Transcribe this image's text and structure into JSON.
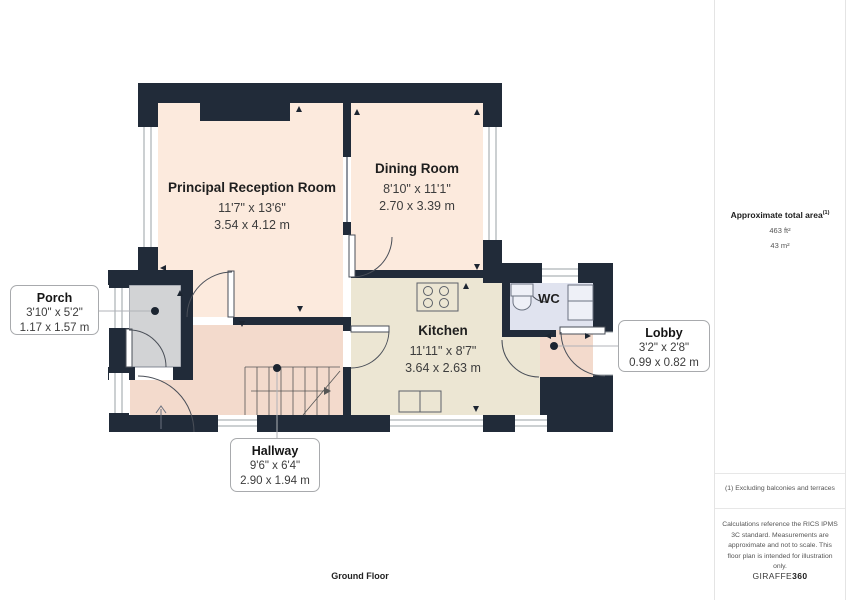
{
  "plan": {
    "floor_label": "Ground Floor",
    "colors": {
      "wall": "#212b39",
      "reception_fill": "#fceadd",
      "dining_fill": "#fceadd",
      "kitchen_fill": "#ece6d3",
      "hallway_fill": "#f3dacc",
      "lobby_fill": "#f3dacc",
      "porch_fill": "#d2d3d5",
      "wc_fill": "#e0e3ef",
      "leader_dot": "#1c2531"
    },
    "rooms": {
      "reception": {
        "name": "Principal Reception Room",
        "dims_imperial": "11'7\" x 13'6\"",
        "dims_metric": "3.54 x 4.12 m"
      },
      "dining": {
        "name": "Dining Room",
        "dims_imperial": "8'10\" x 11'1\"",
        "dims_metric": "2.70 x 3.39 m"
      },
      "kitchen": {
        "name": "Kitchen",
        "dims_imperial": "11'11\" x 8'7\"",
        "dims_metric": "3.64 x 2.63 m"
      },
      "wc": {
        "name": "WC"
      },
      "porch": {
        "name": "Porch",
        "dims_imperial": "3'10\" x 5'2\"",
        "dims_metric": "1.17 x 1.57 m"
      },
      "lobby": {
        "name": "Lobby",
        "dims_imperial": "3'2\" x 2'8\"",
        "dims_metric": "0.99 x 0.82 m"
      },
      "hallway": {
        "name": "Hallway",
        "dims_imperial": "9'6\" x 6'4\"",
        "dims_metric": "2.90 x 1.94 m"
      }
    }
  },
  "sidebar": {
    "total_area_label": "Approximate total area",
    "total_area_footnote_mark": "(1)",
    "area_ft": "463 ft²",
    "area_m": "43 m²",
    "footnote": "(1) Excluding balconies and terraces",
    "disclaimer": "Calculations reference the RICS IPMS 3C standard. Measurements are approximate and not to scale. This floor plan is intended for illustration only.",
    "brand_regular": "GIRAFFE",
    "brand_bold": "360"
  }
}
